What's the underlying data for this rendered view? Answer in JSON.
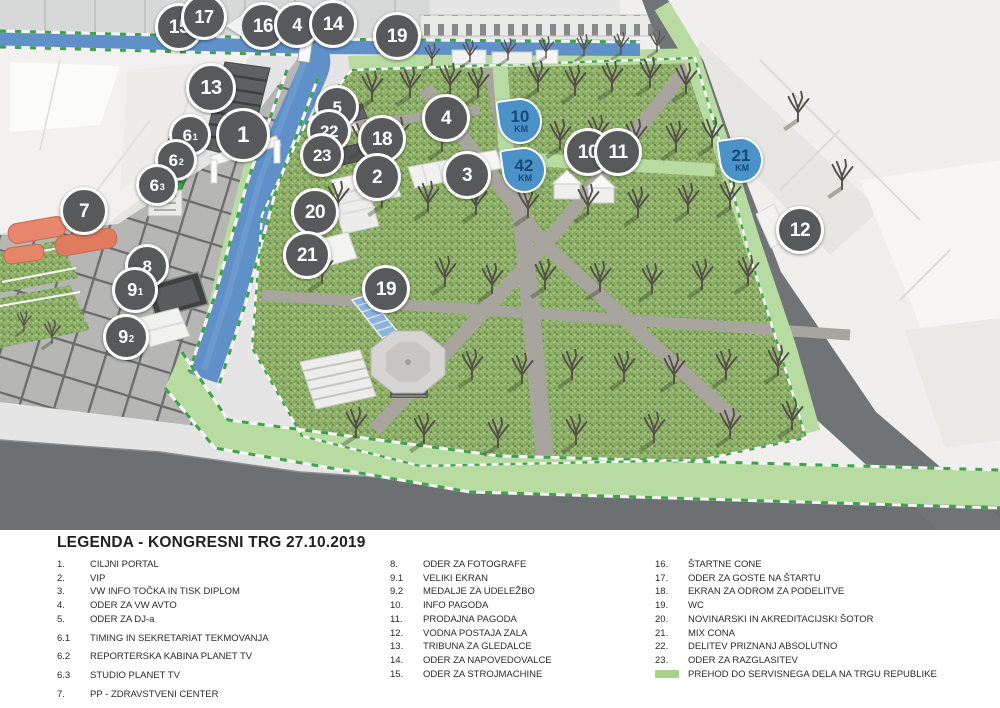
{
  "legend": {
    "title": "LEGENDA - KONGRESNI TRG 27.10.2019",
    "columns": [
      {
        "items": [
          {
            "num": "1.",
            "label": "CILJNI PORTAL"
          },
          {
            "num": "2.",
            "label": "VIP"
          },
          {
            "num": "3.",
            "label": "VW INFO TOČKA IN TISK DIPLOM"
          },
          {
            "num": "4.",
            "label": "ODER ZA VW AVTO"
          },
          {
            "num": "5.",
            "label": "ODER ZA DJ-a"
          },
          {
            "num": "6.1",
            "label": "TIMING IN SEKRETARIAT TEKMOVANJA",
            "spaced": true
          },
          {
            "num": "6.2",
            "label": "REPORTERSKA KABINA PLANET TV",
            "spaced": true
          },
          {
            "num": "6.3",
            "label": "STUDIO PLANET TV",
            "spaced": true
          },
          {
            "num": "7.",
            "label": "PP - ZDRAVSTVENI CENTER",
            "spaced": true
          }
        ]
      },
      {
        "items": [
          {
            "num": "8.",
            "label": "ODER ZA FOTOGRAFE"
          },
          {
            "num": "9.1",
            "label": "VELIKI EKRAN"
          },
          {
            "num": "9.2",
            "label": "MEDALJE ZA UDELEŽBO"
          },
          {
            "num": "10.",
            "label": "INFO PAGODA"
          },
          {
            "num": "11.",
            "label": "PRODAJNA PAGODA"
          },
          {
            "num": "12.",
            "label": "VODNA POSTAJA ZALA"
          },
          {
            "num": "13.",
            "label": "TRIBUNA ZA GLEDALCE"
          },
          {
            "num": "14.",
            "label": "ODER ZA NAPOVEDOVALCE"
          },
          {
            "num": "15.",
            "label": "ODER ZA STROJMACHINE"
          }
        ]
      },
      {
        "items": [
          {
            "num": "16.",
            "label": "ŠTARTNE CONE"
          },
          {
            "num": "17.",
            "label": "ODER ZA GOSTE NA ŠTARTU"
          },
          {
            "num": "18.",
            "label": "EKRAN ZA ODROM ZA PODELITVE"
          },
          {
            "num": "19.",
            "label": "WC"
          },
          {
            "num": "20.",
            "label": "NOVINARSKI IN AKREDITACIJSKI ŠOTOR"
          },
          {
            "num": "21.",
            "label": "MIX CONA"
          },
          {
            "num": "22.",
            "label": "DELITEV PRIZNANJ ABSOLUTNO"
          },
          {
            "num": "23.",
            "label": "ODER ZA RAZGLASITEV"
          },
          {
            "num": "",
            "label": "PREHOD DO SERVISNEGA DELA NA TRGU REPUBLIKE",
            "swatch": true
          }
        ]
      }
    ]
  },
  "map": {
    "colors": {
      "marker_bg": "#58595b",
      "marker_text": "#ffffff",
      "km_badge_bg": "#4b92c8",
      "km_badge_text": "#17497b",
      "course_blue": "#6090c8",
      "route_green": "#b7dba1",
      "legend_swatch": "#a9d18e"
    },
    "markers": [
      {
        "id": "15",
        "label": "15",
        "x": 179,
        "y": 27,
        "size": 42
      },
      {
        "id": "17",
        "label": "17",
        "x": 204,
        "y": 17,
        "size": 40
      },
      {
        "id": "16",
        "label": "16",
        "x": 263,
        "y": 26,
        "size": 42,
        "arrow": true
      },
      {
        "id": "4a",
        "label": "4",
        "x": 297,
        "y": 25,
        "size": 40
      },
      {
        "id": "14",
        "label": "14",
        "x": 333,
        "y": 24,
        "size": 42
      },
      {
        "id": "19a",
        "label": "19",
        "x": 397,
        "y": 36,
        "size": 42
      },
      {
        "id": "13",
        "label": "13",
        "x": 211,
        "y": 88,
        "size": 44
      },
      {
        "id": "1",
        "label": "1",
        "x": 243,
        "y": 135,
        "size": 48
      },
      {
        "id": "6-1",
        "label": "6",
        "sub": "1",
        "x": 190,
        "y": 135,
        "size": 36
      },
      {
        "id": "6-2",
        "label": "6",
        "sub": "2",
        "x": 176,
        "y": 160,
        "size": 36
      },
      {
        "id": "6-3",
        "label": "6",
        "sub": "3",
        "x": 157,
        "y": 185,
        "size": 36
      },
      {
        "id": "5",
        "label": "5",
        "x": 337,
        "y": 107,
        "size": 38
      },
      {
        "id": "22",
        "label": "22",
        "x": 329,
        "y": 131,
        "size": 38
      },
      {
        "id": "23",
        "label": "23",
        "x": 322,
        "y": 155,
        "size": 38
      },
      {
        "id": "18",
        "label": "18",
        "x": 382,
        "y": 139,
        "size": 42
      },
      {
        "id": "2",
        "label": "2",
        "x": 377,
        "y": 177,
        "size": 42
      },
      {
        "id": "4b",
        "label": "4",
        "x": 446,
        "y": 118,
        "size": 42
      },
      {
        "id": "3",
        "label": "3",
        "x": 467,
        "y": 175,
        "size": 42
      },
      {
        "id": "10",
        "label": "10",
        "x": 588,
        "y": 152,
        "size": 42
      },
      {
        "id": "11",
        "label": "11",
        "x": 618,
        "y": 152,
        "size": 42
      },
      {
        "id": "12",
        "label": "12",
        "x": 800,
        "y": 230,
        "size": 42
      },
      {
        "id": "7",
        "label": "7",
        "x": 84,
        "y": 211,
        "size": 42
      },
      {
        "id": "20",
        "label": "20",
        "x": 315,
        "y": 212,
        "size": 42
      },
      {
        "id": "21",
        "label": "21",
        "x": 307,
        "y": 255,
        "size": 42
      },
      {
        "id": "8",
        "label": "8",
        "x": 147,
        "y": 266,
        "size": 38
      },
      {
        "id": "9-1",
        "label": "9",
        "sub": "1",
        "x": 135,
        "y": 290,
        "size": 40
      },
      {
        "id": "9-2",
        "label": "9",
        "sub": "2",
        "x": 126,
        "y": 337,
        "size": 40
      },
      {
        "id": "19b",
        "label": "19",
        "x": 386,
        "y": 289,
        "size": 42
      }
    ],
    "km_badges": [
      {
        "id": "10km",
        "value": "10",
        "unit": "KM",
        "x": 520,
        "y": 121
      },
      {
        "id": "42km",
        "value": "42",
        "unit": "KM",
        "x": 524,
        "y": 170
      },
      {
        "id": "21km",
        "value": "21",
        "unit": "KM",
        "x": 741,
        "y": 160
      }
    ]
  }
}
